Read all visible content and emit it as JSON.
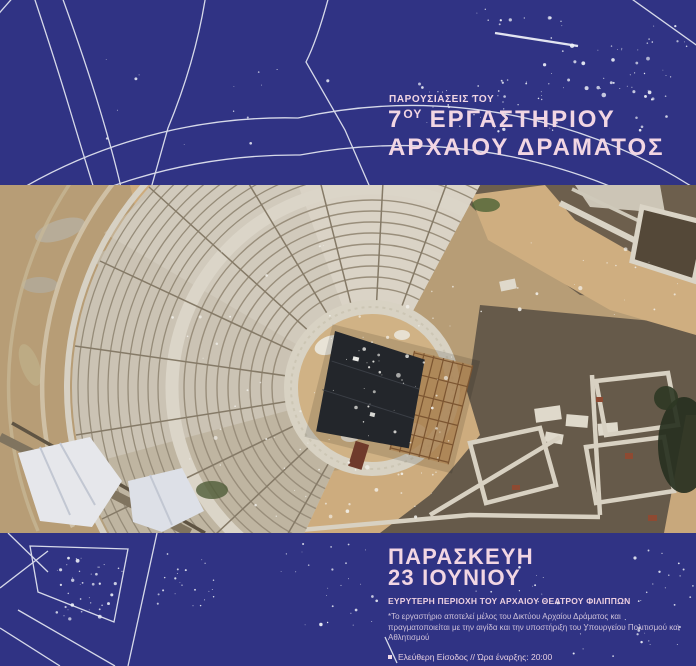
{
  "header": {
    "kicker": "ΠΑΡΟΥΣΙΑΣΕΙΣ ΤΟΥ",
    "title_number": "7",
    "title_ordinal": "ΟΥ",
    "title_rest": "ΕΡΓΑΣΤΗΡΙΟΥ",
    "title_line2": "ΑΡΧΑΙΟΥ ΔΡΑΜΑΤΟΣ"
  },
  "footer": {
    "date_line1": "ΠΑΡΑΣΚΕΥΗ",
    "date_line2": "23 ΙΟΥΝΙΟΥ",
    "location": "ΕΥΡΥΤΕΡΗ ΠΕΡΙΟΧΗ ΤΟΥ ΑΡΧΑΙΟΥ ΘΕΑΤΡΟΥ ΦΙΛΙΠΠΩΝ",
    "note": "*Το εργαστήριο αποτελεί μέλος του Δικτύου Αρχαίου Δράματος και πραγματοποιείται με την αιγίδα και την υποστήριξη του Υπουργείου Πολιτισμού και Αθλητισμού",
    "admission": "Ελεύθερη Είσοδος  // Ώρα έναρξης: 20:00"
  },
  "colors": {
    "background": "#303384",
    "accent_pink": "#f2d6e3",
    "accent_pink_deep": "#eccfe0",
    "note_text": "#cfc2da",
    "line_white": "#e9ecf5"
  }
}
